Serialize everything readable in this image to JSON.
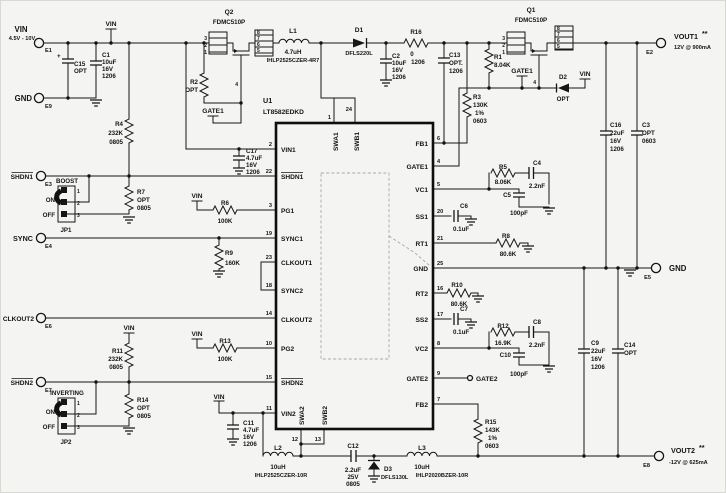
{
  "schematic": {
    "ic": {
      "ref": "U1",
      "part": "LT8582EDKD",
      "left_pins": [
        {
          "num": "2",
          "name": "VIN1"
        },
        {
          "num": "22",
          "name": "SHDN1"
        },
        {
          "num": "3",
          "name": "PG1"
        },
        {
          "num": "19",
          "name": "SYNC1"
        },
        {
          "num": "23",
          "name": "CLKOUT1"
        },
        {
          "num": "18",
          "name": "SYNC2"
        },
        {
          "num": "14",
          "name": "CLKOUT2"
        },
        {
          "num": "10",
          "name": "PG2"
        },
        {
          "num": "15",
          "name": "SHDN2"
        },
        {
          "num": "11",
          "name": "VIN2"
        }
      ],
      "right_pins": [
        {
          "num": "6",
          "name": "FB1"
        },
        {
          "num": "4",
          "name": "GATE1"
        },
        {
          "num": "5",
          "name": "VC1"
        },
        {
          "num": "20",
          "name": "SS1"
        },
        {
          "num": "21",
          "name": "RT1"
        },
        {
          "num": "25",
          "name": "GND"
        },
        {
          "num": "16",
          "name": "RT2"
        },
        {
          "num": "17",
          "name": "SS2"
        },
        {
          "num": "8",
          "name": "VC2"
        },
        {
          "num": "9",
          "name": "GATE2"
        },
        {
          "num": "7",
          "name": "FB2"
        }
      ],
      "top_pins": [
        {
          "num": "1",
          "name": "SWA1"
        },
        {
          "num": "24",
          "name": "SWB1"
        }
      ],
      "bottom_pins": [
        {
          "num": "12",
          "name": "SWA2"
        },
        {
          "num": "13",
          "name": "SWB2"
        }
      ]
    },
    "terminals": {
      "e1": {
        "name": "E1",
        "label": "VIN",
        "sub": "4.5V - 10V"
      },
      "e9": {
        "name": "E9",
        "label": "GND"
      },
      "e3": {
        "name": "E3",
        "label": "SHDN1"
      },
      "e4": {
        "name": "E4",
        "label": "SYNC"
      },
      "e6": {
        "name": "E6",
        "label": "CLKOUT2"
      },
      "e7": {
        "name": "E7",
        "label": "SHDN2"
      },
      "e2": {
        "name": "E2",
        "label": "VOUT1",
        "note": "**",
        "sub": "12V @ 900mA"
      },
      "e5": {
        "name": "E5",
        "label": "GND"
      },
      "e8": {
        "name": "E8",
        "label": "VOUT2",
        "note": "**",
        "sub": "-12V @ 625mA"
      }
    },
    "jumpers": {
      "jp1": {
        "title": "BOOST",
        "on": "ON",
        "off": "OFF",
        "ref": "JP1",
        "pins": [
          "1",
          "2",
          "3"
        ]
      },
      "jp2": {
        "title": "INVERTING",
        "on": "ON",
        "off": "OFF",
        "ref": "JP2",
        "pins": [
          "1",
          "2",
          "3"
        ]
      }
    },
    "net_labels": {
      "vin": "VIN",
      "gate1": "GATE1",
      "gate2": "GATE2"
    },
    "parts": {
      "c15": {
        "ref": "C15",
        "a": "OPT",
        "plus": "+"
      },
      "c1": {
        "ref": "C1",
        "a": "10uF",
        "b": "16V",
        "c": "1206"
      },
      "r4": {
        "ref": "R4",
        "a": "232K",
        "b": "0805"
      },
      "q2": {
        "ref": "Q2",
        "part": "FDMC510P",
        "pl": [
          "3",
          "2",
          "1"
        ],
        "pr": [
          "8",
          "7",
          "6",
          "5"
        ],
        "pg": "4"
      },
      "r2": {
        "ref": "R2",
        "a": "OPT"
      },
      "l1": {
        "ref": "L1",
        "a": "4.7uH",
        "b": "IHLP2525CZER-4R7"
      },
      "d1": {
        "ref": "D1",
        "part": "DFLS220L"
      },
      "c2": {
        "ref": "C2",
        "a": "10uF",
        "b": "16V",
        "c": "1206"
      },
      "r16": {
        "ref": "R16",
        "a": "0",
        "b": "1206"
      },
      "c13": {
        "ref": "C13",
        "a": "OPT.",
        "b": "1206"
      },
      "r3": {
        "ref": "R3",
        "a": "130K",
        "b": "1%",
        "c": "0603"
      },
      "r1": {
        "ref": "R1",
        "a": "8.04K"
      },
      "q1": {
        "ref": "Q1",
        "part": "FDMC510P",
        "pl": [
          "3",
          "2",
          "1"
        ],
        "pr": [
          "8",
          "7",
          "6",
          "5"
        ],
        "pg": "4"
      },
      "d2": {
        "ref": "D2",
        "a": "OPT"
      },
      "c16": {
        "ref": "C16",
        "a": "22uF",
        "b": "16V",
        "c": "1206"
      },
      "c3": {
        "ref": "C3",
        "a": "OPT",
        "b": "0603"
      },
      "c17": {
        "ref": "C17",
        "a": "4.7uF",
        "b": "16V",
        "c": "1206"
      },
      "r7": {
        "ref": "R7",
        "a": "OPT",
        "b": "0805"
      },
      "r6": {
        "ref": "R6",
        "a": "100K"
      },
      "r9": {
        "ref": "R9",
        "a": "160K"
      },
      "r13": {
        "ref": "R13",
        "a": "100K"
      },
      "r11": {
        "ref": "R11",
        "a": "232K",
        "b": "0805"
      },
      "r14": {
        "ref": "R14",
        "a": "OPT",
        "b": "0805"
      },
      "c11": {
        "ref": "C11",
        "a": "4.7uF",
        "b": "16V",
        "c": "1206"
      },
      "l2": {
        "ref": "L2",
        "a": "10uH",
        "b": "IHLP2525CZER-10R"
      },
      "c12": {
        "ref": "C12",
        "a": "2.2uF",
        "b": "25V",
        "c": "0805"
      },
      "d3": {
        "ref": "D3",
        "part": "DFLS130L"
      },
      "l3": {
        "ref": "L3",
        "a": "10uH",
        "b": "IHLP2020BZER-10R"
      },
      "r5": {
        "ref": "R5",
        "a": "8.06K"
      },
      "c4": {
        "ref": "C4",
        "a": "2.2nF"
      },
      "c5": {
        "ref": "C5",
        "a": "100pF"
      },
      "c6": {
        "ref": "C6",
        "a": "0.1uF"
      },
      "r8": {
        "ref": "R8",
        "a": "80.6K"
      },
      "r10": {
        "ref": "R10",
        "a": "80.6K"
      },
      "c7": {
        "ref": "C7",
        "a": "0.1uF"
      },
      "r12": {
        "ref": "R12",
        "a": "16.9K"
      },
      "c8": {
        "ref": "C8",
        "a": "2.2nF"
      },
      "c10": {
        "ref": "C10",
        "a": "100pF"
      },
      "r15": {
        "ref": "R15",
        "a": "143K",
        "b": "1%",
        "c": "0603"
      },
      "c9": {
        "ref": "C9",
        "a": "22uF",
        "b": "16V",
        "c": "1206"
      },
      "c14": {
        "ref": "C14",
        "a": "OPT",
        "b": "0603"
      }
    }
  }
}
